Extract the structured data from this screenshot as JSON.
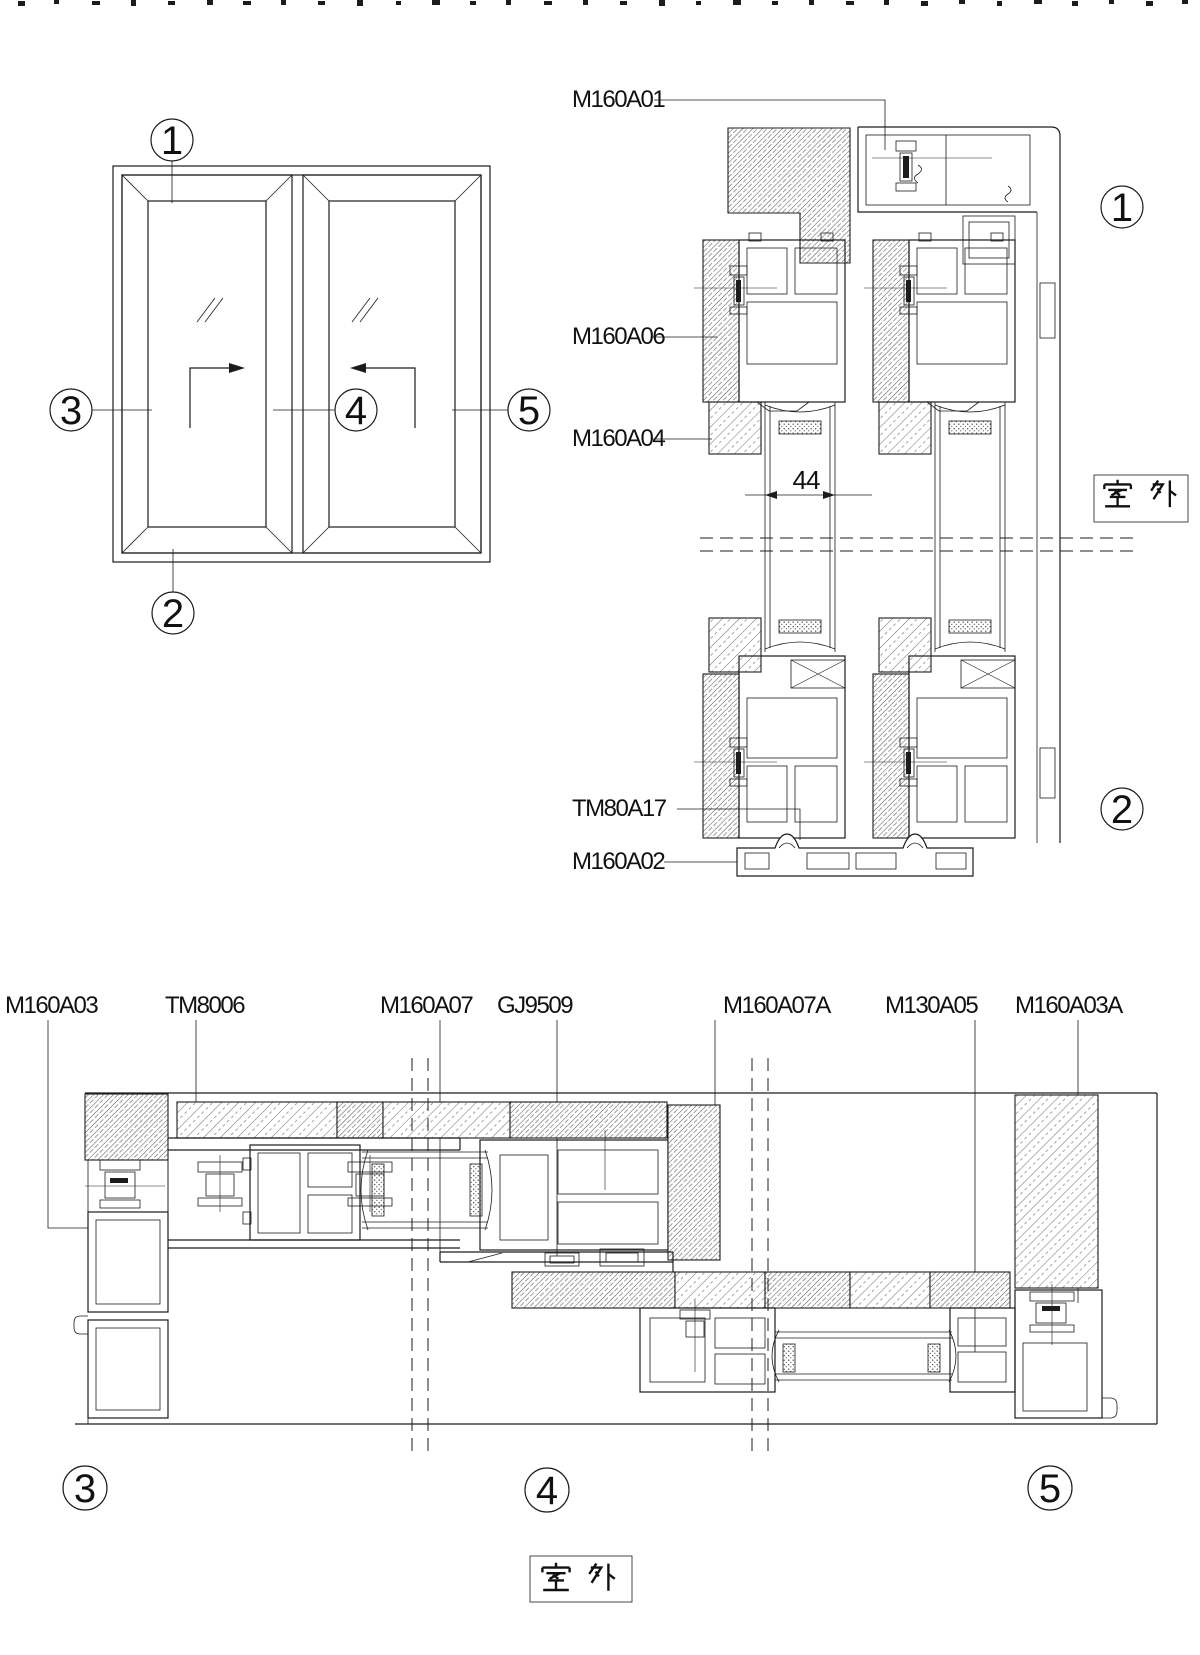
{
  "outdoor_label": "室 外",
  "colors": {
    "line": "#1c1c1c",
    "background": "#ffffff",
    "text": "#111111"
  },
  "elevation": {
    "markers": [
      "1",
      "2",
      "3",
      "4",
      "5"
    ]
  },
  "vertical_section": {
    "part_labels": [
      "M160A01",
      "M160A06",
      "M160A04",
      "TM80A17",
      "M160A02"
    ],
    "dimension": "44",
    "markers": [
      "1",
      "2"
    ]
  },
  "horizontal_section": {
    "part_labels": [
      "M160A03",
      "TM8006",
      "M160A07",
      "GJ9509",
      "M160A07A",
      "M130A05",
      "M160A03A"
    ],
    "markers": [
      "3",
      "4",
      "5"
    ]
  }
}
